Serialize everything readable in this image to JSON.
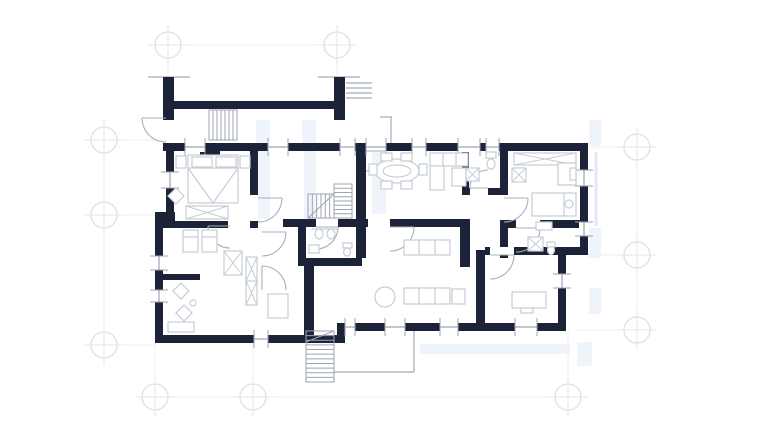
{
  "canvas": {
    "width": 770,
    "height": 434,
    "background": "#ffffff"
  },
  "palette": {
    "bg": "#ffffff",
    "wall": "#1c2238",
    "furniture": "#c6cdd6",
    "fixture": "#9da5af",
    "stair": "#9da5af",
    "door": "#a8b0ba",
    "site": "#b3bac2",
    "grid": "#e2e6ea",
    "grid_line": "#edeff2",
    "tint": "#e7eef7",
    "overlay_line": "#dbe6f2"
  },
  "grid": {
    "marker_radius": 13,
    "markers": [
      [
        168,
        45
      ],
      [
        337,
        45
      ],
      [
        104,
        140
      ],
      [
        104,
        215
      ],
      [
        104,
        345
      ],
      [
        155,
        397
      ],
      [
        253,
        397
      ],
      [
        568,
        397
      ],
      [
        637,
        147
      ],
      [
        637,
        255
      ],
      [
        637,
        330
      ]
    ],
    "lines": [
      [
        168,
        45,
        337,
        45
      ],
      [
        168,
        45,
        168,
        80
      ],
      [
        337,
        45,
        337,
        80
      ],
      [
        104,
        128,
        104,
        358
      ],
      [
        92,
        140,
        166,
        140
      ],
      [
        92,
        215,
        155,
        215
      ],
      [
        92,
        345,
        155,
        345
      ],
      [
        155,
        343,
        155,
        410
      ],
      [
        253,
        343,
        253,
        410
      ],
      [
        568,
        331,
        568,
        410
      ],
      [
        143,
        397,
        580,
        397
      ],
      [
        637,
        135,
        637,
        342
      ],
      [
        588,
        147,
        652,
        147
      ],
      [
        588,
        255,
        652,
        255
      ],
      [
        576,
        330,
        652,
        330
      ]
    ]
  },
  "overlay": {
    "tints": [
      [
        256,
        120,
        14,
        23
      ],
      [
        302,
        120,
        14,
        23
      ],
      [
        258,
        151,
        12,
        68
      ],
      [
        304,
        151,
        12,
        68
      ],
      [
        372,
        152,
        14,
        62
      ],
      [
        589,
        120,
        12,
        26
      ],
      [
        589,
        228,
        12,
        30
      ],
      [
        589,
        288,
        12,
        26
      ],
      [
        420,
        344,
        150,
        10
      ],
      [
        577,
        342,
        15,
        24
      ]
    ],
    "lines": [
      [
        596,
        152,
        596,
        226
      ]
    ]
  },
  "site_lines": [
    [
      148,
      77,
      190,
      77
    ],
    [
      318,
      77,
      360,
      77
    ],
    [
      346,
      83,
      372,
      83
    ],
    [
      346,
      88,
      372,
      88
    ],
    [
      346,
      93,
      372,
      93
    ],
    [
      346,
      98,
      372,
      98
    ],
    [
      380,
      117,
      392,
      117
    ],
    [
      391,
      117,
      391,
      148
    ],
    [
      334,
      372,
      414,
      372
    ],
    [
      414,
      331,
      414,
      372
    ]
  ],
  "walls": [
    [
      163,
      143,
      425,
      8
    ],
    [
      580,
      143,
      8,
      112
    ],
    [
      558,
      247,
      30,
      8
    ],
    [
      558,
      255,
      8,
      76
    ],
    [
      345,
      323,
      221,
      8
    ],
    [
      337,
      323,
      8,
      20
    ],
    [
      155,
      335,
      190,
      8
    ],
    [
      155,
      218,
      8,
      125
    ],
    [
      155,
      212,
      20,
      10
    ],
    [
      166,
      143,
      8,
      75
    ],
    [
      163,
      77,
      11,
      43
    ],
    [
      334,
      77,
      11,
      43
    ],
    [
      167,
      101,
      178,
      8
    ],
    [
      250,
      143,
      8,
      52
    ],
    [
      163,
      221,
      95,
      7
    ],
    [
      283,
      219,
      85,
      8
    ],
    [
      356,
      143,
      10,
      115
    ],
    [
      390,
      219,
      80,
      8
    ],
    [
      500,
      143,
      8,
      85
    ],
    [
      462,
      151,
      7,
      44
    ],
    [
      462,
      188,
      46,
      7
    ],
    [
      508,
      220,
      72,
      8
    ],
    [
      500,
      220,
      8,
      38
    ],
    [
      460,
      223,
      10,
      44
    ],
    [
      476,
      250,
      9,
      75
    ],
    [
      300,
      258,
      62,
      8
    ],
    [
      298,
      227,
      8,
      39
    ],
    [
      155,
      274,
      45,
      6
    ],
    [
      304,
      266,
      10,
      69
    ],
    [
      485,
      247,
      81,
      8
    ],
    [
      200,
      151,
      20,
      7
    ],
    [
      206,
      158,
      8,
      13
    ]
  ],
  "door_gaps": [
    [
      228,
      221,
      22,
      7
    ],
    [
      516,
      220,
      24,
      8
    ],
    [
      490,
      247,
      24,
      8
    ],
    [
      470,
      188,
      18,
      7
    ],
    [
      500,
      195,
      8,
      25
    ],
    [
      316,
      219,
      22,
      8
    ]
  ],
  "windows": {
    "wall_thickness": 8,
    "h": [
      [
        185,
        143,
        20
      ],
      [
        268,
        143,
        20
      ],
      [
        340,
        143,
        15
      ],
      [
        366,
        143,
        20
      ],
      [
        412,
        143,
        14
      ],
      [
        458,
        143,
        22
      ],
      [
        486,
        143,
        13
      ],
      [
        345,
        323,
        10
      ],
      [
        385,
        323,
        20
      ],
      [
        440,
        323,
        18
      ],
      [
        515,
        323,
        22
      ],
      [
        254,
        335,
        14
      ]
    ],
    "v": [
      [
        166,
        172,
        16
      ],
      [
        155,
        256,
        14
      ],
      [
        155,
        290,
        12
      ],
      [
        580,
        170,
        16
      ],
      [
        580,
        222,
        14
      ],
      [
        558,
        274,
        14
      ]
    ]
  },
  "doors": [
    {
      "n": "entry-door",
      "c": [
        166,
        118
      ],
      "r": 24,
      "s": [
        142,
        118
      ],
      "e": [
        166,
        142
      ],
      "sweep": 0
    },
    {
      "n": "bedroom-door",
      "c": [
        258,
        198
      ],
      "r": 24,
      "s": [
        282,
        198
      ],
      "e": [
        258,
        222
      ],
      "sweep": 1
    },
    {
      "n": "bedroom-door",
      "c": [
        230,
        226
      ],
      "r": 22,
      "s": [
        208,
        226
      ],
      "e": [
        230,
        248
      ],
      "sweep": 0
    },
    {
      "n": "corridor-door",
      "c": [
        262,
        232
      ],
      "r": 24,
      "s": [
        286,
        232
      ],
      "e": [
        262,
        256
      ],
      "sweep": 1
    },
    {
      "n": "corridor-door",
      "c": [
        262,
        290
      ],
      "r": 24,
      "s": [
        262,
        266
      ],
      "e": [
        286,
        290
      ],
      "sweep": 1
    },
    {
      "n": "bath-door",
      "c": [
        316,
        227
      ],
      "r": 22,
      "s": [
        338,
        227
      ],
      "e": [
        316,
        249
      ],
      "sweep": 1
    },
    {
      "n": "living-door",
      "c": [
        390,
        227
      ],
      "r": 24,
      "s": [
        414,
        227
      ],
      "e": [
        390,
        251
      ],
      "sweep": 1
    },
    {
      "n": "bath-door",
      "c": [
        488,
        188
      ],
      "r": 18,
      "s": [
        470,
        188
      ],
      "e": [
        488,
        170
      ],
      "sweep": 1
    },
    {
      "n": "bedroom-door",
      "c": [
        504,
        198
      ],
      "r": 24,
      "s": [
        528,
        198
      ],
      "e": [
        504,
        222
      ],
      "sweep": 1
    },
    {
      "n": "bath-door",
      "c": [
        516,
        228
      ],
      "r": 24,
      "s": [
        540,
        228
      ],
      "e": [
        516,
        252
      ],
      "sweep": 1
    },
    {
      "n": "office-door",
      "c": [
        490,
        255
      ],
      "r": 24,
      "s": [
        514,
        255
      ],
      "e": [
        490,
        279
      ],
      "sweep": 1
    },
    {
      "n": "terrace-door",
      "c": [
        366,
        151
      ],
      "r": 20,
      "s": [
        386,
        151
      ],
      "e": [
        366,
        171
      ],
      "sweep": 1
    }
  ],
  "stairs": [
    {
      "n": "entry-steps",
      "r": [
        209,
        110,
        28,
        30
      ],
      "dir": "v",
      "steps": 6
    },
    {
      "n": "stair-flight",
      "r": [
        334,
        184,
        18,
        34
      ],
      "dir": "h",
      "steps": 7
    },
    {
      "n": "stair-flight",
      "r": [
        308,
        194,
        26,
        24
      ],
      "dir": "v",
      "steps": 5,
      "diag": [
        [
          308,
          218,
          334,
          194
        ]
      ]
    },
    {
      "n": "exterior-stair",
      "r": [
        306,
        331,
        28,
        51
      ],
      "dir": "h",
      "steps": 10,
      "diag": [
        [
          306,
          342,
          334,
          331
        ]
      ]
    }
  ],
  "furniture": [
    {
      "t": "rect",
      "n": "nightstand",
      "r": [
        176,
        156,
        10,
        12
      ]
    },
    {
      "t": "rect",
      "n": "nightstand",
      "r": [
        240,
        156,
        10,
        12
      ]
    },
    {
      "t": "rect",
      "n": "double-bed",
      "r": [
        188,
        155,
        50,
        48
      ]
    },
    {
      "t": "line",
      "n": "bed-line",
      "p": [
        188,
        168,
        238,
        168
      ]
    },
    {
      "t": "line",
      "n": "bed-line",
      "p": [
        188,
        168,
        213,
        203
      ]
    },
    {
      "t": "line",
      "n": "bed-line",
      "p": [
        238,
        168,
        213,
        203
      ]
    },
    {
      "t": "rect",
      "n": "pillow",
      "r": [
        192,
        157,
        20,
        10
      ]
    },
    {
      "t": "rect",
      "n": "pillow",
      "r": [
        216,
        157,
        20,
        10
      ]
    },
    {
      "t": "diamond",
      "n": "chair",
      "c": [
        176,
        196
      ],
      "s": 8
    },
    {
      "t": "xrect",
      "n": "wardrobe",
      "r": [
        186,
        206,
        42,
        13
      ]
    },
    {
      "t": "rect",
      "n": "single-bed",
      "r": [
        183,
        230,
        15,
        22
      ]
    },
    {
      "t": "line",
      "n": "bed-line",
      "p": [
        183,
        237,
        198,
        237
      ]
    },
    {
      "t": "rect",
      "n": "single-bed",
      "r": [
        202,
        230,
        15,
        22
      ]
    },
    {
      "t": "line",
      "n": "bed-line",
      "p": [
        202,
        237,
        217,
        237
      ]
    },
    {
      "t": "xrect",
      "n": "wardrobe",
      "r": [
        224,
        251,
        18,
        24
      ]
    },
    {
      "t": "xrect",
      "n": "wardrobe",
      "r": [
        246,
        257,
        11,
        24
      ]
    },
    {
      "t": "xrect",
      "n": "wardrobe",
      "r": [
        246,
        281,
        11,
        24
      ]
    },
    {
      "t": "diamond",
      "n": "chair",
      "c": [
        181,
        291
      ],
      "s": 8
    },
    {
      "t": "diamond",
      "n": "chair",
      "c": [
        184,
        313
      ],
      "s": 8
    },
    {
      "t": "circle",
      "n": "stool",
      "c": [
        193,
        303
      ],
      "r": 3
    },
    {
      "t": "rect",
      "n": "bench",
      "r": [
        168,
        322,
        26,
        10
      ]
    },
    {
      "t": "rect",
      "n": "dresser",
      "r": [
        268,
        294,
        20,
        24
      ]
    },
    {
      "t": "oval",
      "n": "sink",
      "c": [
        319,
        234
      ],
      "rx": 4,
      "ry": 5
    },
    {
      "t": "oval",
      "n": "sink",
      "c": [
        331,
        234
      ],
      "rx": 4,
      "ry": 5
    },
    {
      "t": "line",
      "n": "counter-line",
      "p": [
        312,
        229,
        338,
        229
      ]
    },
    {
      "t": "rect",
      "n": "toilet-tank",
      "r": [
        343,
        243,
        9,
        5
      ]
    },
    {
      "t": "oval",
      "n": "toilet",
      "c": [
        347,
        252
      ],
      "rx": 3.5,
      "ry": 4
    },
    {
      "t": "rect",
      "n": "bidet",
      "r": [
        309,
        245,
        10,
        8
      ]
    },
    {
      "t": "oval",
      "n": "dining-table",
      "c": [
        397,
        171
      ],
      "rx": 22,
      "ry": 12
    },
    {
      "t": "oval",
      "n": "dining-table-inner",
      "c": [
        397,
        171
      ],
      "rx": 14,
      "ry": 6
    },
    {
      "t": "rect",
      "n": "chair",
      "r": [
        381,
        153,
        11,
        8
      ]
    },
    {
      "t": "rect",
      "n": "chair",
      "r": [
        401,
        153,
        11,
        8
      ]
    },
    {
      "t": "rect",
      "n": "chair",
      "r": [
        381,
        181,
        11,
        8
      ]
    },
    {
      "t": "rect",
      "n": "chair",
      "r": [
        401,
        181,
        11,
        8
      ]
    },
    {
      "t": "rect",
      "n": "chair",
      "r": [
        369,
        164,
        8,
        11
      ]
    },
    {
      "t": "rect",
      "n": "chair",
      "r": [
        419,
        164,
        8,
        11
      ]
    },
    {
      "t": "rect",
      "n": "kitchen-counter",
      "r": [
        430,
        153,
        38,
        13
      ]
    },
    {
      "t": "line",
      "n": "counter-line",
      "p": [
        443,
        153,
        443,
        166
      ]
    },
    {
      "t": "line",
      "n": "counter-line",
      "p": [
        456,
        153,
        456,
        166
      ]
    },
    {
      "t": "rect",
      "n": "kitchen-cabinet",
      "r": [
        430,
        166,
        14,
        24
      ]
    },
    {
      "t": "rect",
      "n": "kitchen-island",
      "r": [
        452,
        168,
        14,
        18
      ]
    },
    {
      "t": "xrect",
      "n": "washer",
      "r": [
        466,
        168,
        13,
        13
      ]
    },
    {
      "t": "rect",
      "n": "toilet-tank",
      "r": [
        486,
        152,
        10,
        6
      ]
    },
    {
      "t": "oval",
      "n": "toilet",
      "c": [
        491,
        164
      ],
      "rx": 4,
      "ry": 5
    },
    {
      "t": "xrect",
      "n": "wardrobe",
      "r": [
        514,
        153,
        62,
        12
      ]
    },
    {
      "t": "xrect",
      "n": "cabinet",
      "r": [
        512,
        168,
        14,
        14
      ]
    },
    {
      "t": "rect",
      "n": "bed",
      "r": [
        532,
        193,
        44,
        23
      ]
    },
    {
      "t": "line",
      "n": "bed-line",
      "p": [
        564,
        193,
        564,
        216
      ]
    },
    {
      "t": "circle",
      "n": "pillow",
      "c": [
        569,
        204
      ],
      "r": 4
    },
    {
      "t": "rect",
      "n": "nightstand",
      "r": [
        536,
        222,
        16,
        8
      ]
    },
    {
      "t": "rect",
      "n": "window-seat",
      "r": [
        558,
        163,
        18,
        22
      ]
    },
    {
      "t": "rect",
      "n": "window-seat-cushion",
      "r": [
        570,
        168,
        6,
        12
      ]
    },
    {
      "t": "xrect",
      "n": "shower",
      "r": [
        528,
        237,
        15,
        14
      ]
    },
    {
      "t": "oval",
      "n": "toilet",
      "c": [
        551,
        250
      ],
      "rx": 3.5,
      "ry": 4.5
    },
    {
      "t": "rect",
      "n": "toilet-tank",
      "r": [
        547,
        242,
        8,
        5
      ]
    },
    {
      "t": "rect",
      "n": "sofa",
      "r": [
        404,
        240,
        46,
        15
      ]
    },
    {
      "t": "line",
      "n": "sofa-line",
      "p": [
        419,
        240,
        419,
        255
      ]
    },
    {
      "t": "line",
      "n": "sofa-line",
      "p": [
        435,
        240,
        435,
        255
      ]
    },
    {
      "t": "rect",
      "n": "sofa",
      "r": [
        404,
        288,
        46,
        16
      ]
    },
    {
      "t": "line",
      "n": "sofa-line",
      "p": [
        419,
        288,
        419,
        304
      ]
    },
    {
      "t": "line",
      "n": "sofa-line",
      "p": [
        435,
        288,
        435,
        304
      ]
    },
    {
      "t": "rect",
      "n": "armchair",
      "r": [
        452,
        289,
        13,
        15
      ]
    },
    {
      "t": "circle",
      "n": "coffee-table",
      "c": [
        385,
        297
      ],
      "r": 10
    },
    {
      "t": "rect",
      "n": "desk",
      "r": [
        512,
        292,
        34,
        16
      ]
    },
    {
      "t": "rect",
      "n": "desk-chair",
      "r": [
        521,
        308,
        12,
        5
      ]
    }
  ]
}
